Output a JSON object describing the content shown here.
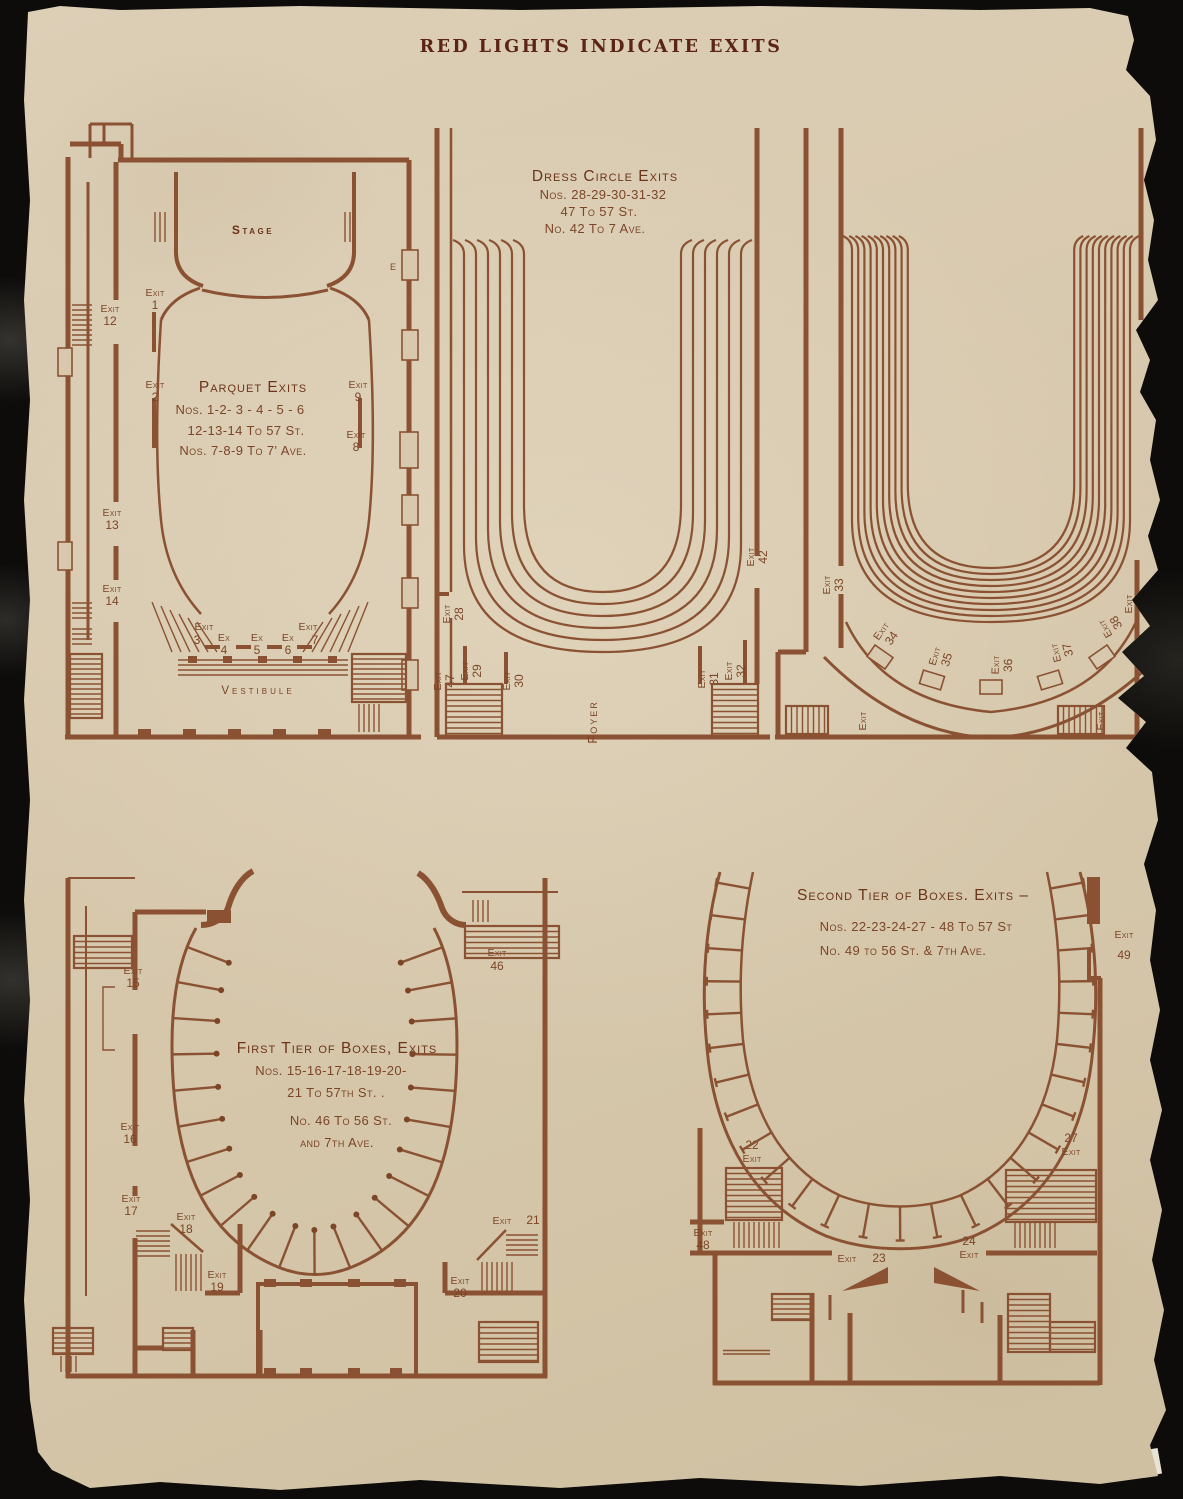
{
  "colors": {
    "background": "#0d0c0a",
    "paper": "#d8c9ae",
    "ink": "#8a5232",
    "dark_ink": "#6c3419",
    "title_ink": "#5c2415"
  },
  "page": {
    "title": "RED LIGHTS INDICATE EXITS"
  },
  "plans": {
    "parquet": {
      "stage": "Stage",
      "vestibule": "Vestibule",
      "door": "E",
      "heading": "Parquet Exits",
      "notes": [
        "Nos. 1-2- 3 - 4 - 5 - 6",
        "12-13-14 To 57 St.",
        "Nos. 7-8-9  To 7' Ave."
      ],
      "exits": [
        {
          "word": "Exit",
          "num": "1"
        },
        {
          "word": "Exit",
          "num": "12"
        },
        {
          "word": "Exit",
          "num": "2"
        },
        {
          "word": "Exit",
          "num": "9"
        },
        {
          "word": "Exit",
          "num": "8"
        },
        {
          "word": "Exit",
          "num": "13"
        },
        {
          "word": "Exit",
          "num": "14"
        },
        {
          "word": "Exit",
          "num": "3"
        },
        {
          "word": "Ex",
          "num": "4"
        },
        {
          "word": "Ex",
          "num": "5"
        },
        {
          "word": "Ex",
          "num": "6"
        },
        {
          "word": "Exit",
          "num": "7"
        }
      ]
    },
    "dress_circle": {
      "heading": "Dress Circle Exits",
      "notes": [
        "Nos. 28-29-30-31-32",
        "47 To 57 St.",
        "No. 42 To 7 Ave."
      ],
      "foyer": "Foyer",
      "exits": [
        {
          "word": "Exit",
          "num": "28"
        },
        {
          "word": "Exit",
          "num": "47"
        },
        {
          "word": "Exit",
          "num": "29"
        },
        {
          "word": "Exit",
          "num": "30"
        },
        {
          "word": "Exit",
          "num": "42"
        },
        {
          "word": "Exit",
          "num": "31"
        },
        {
          "word": "Exit",
          "num": "32"
        }
      ]
    },
    "balcony": {
      "exits": [
        {
          "word": "Exit",
          "num": "33"
        },
        {
          "word": "Exit",
          "num": "34"
        },
        {
          "word": "Exit",
          "num": "35"
        },
        {
          "word": "Exit",
          "num": "36"
        },
        {
          "word": "Exit",
          "num": "37"
        },
        {
          "word": "Exit",
          "num": "38"
        },
        {
          "word": "Exit",
          "num": "39"
        },
        {
          "word": "Exit",
          "num": ""
        },
        {
          "word": "Exit",
          "num": ""
        }
      ]
    },
    "first_tier": {
      "heading": "First Tier of Boxes, Exits",
      "notes": [
        "Nos. 15-16-17-18-19-20-",
        "21 To 57th St. .",
        "No.  46 To 56 St.",
        "and 7th Ave."
      ],
      "exits": [
        {
          "word": "Exit",
          "num": "15"
        },
        {
          "word": "Exit",
          "num": "16"
        },
        {
          "word": "Exit",
          "num": "17"
        },
        {
          "word": "Exit",
          "num": "18"
        },
        {
          "word": "Exit",
          "num": "19"
        },
        {
          "word": "Exit",
          "num": "46"
        },
        {
          "word": "Exit",
          "num": "21"
        },
        {
          "word": "Exit",
          "num": "20"
        }
      ]
    },
    "second_tier": {
      "heading": "Second Tier of Boxes. Exits –",
      "notes": [
        "Nos. 22-23-24-27 - 48 To 57 St",
        "No.  49 to 56 St. & 7th Ave."
      ],
      "exits": [
        {
          "word": "Exit",
          "num": "49"
        },
        {
          "word": "Exit",
          "num": "22"
        },
        {
          "word": "Exit",
          "num": "48"
        },
        {
          "word": "Exit",
          "num": "23"
        },
        {
          "word": "Exit",
          "num": "24"
        },
        {
          "word": "Exit",
          "num": "27"
        }
      ]
    }
  }
}
